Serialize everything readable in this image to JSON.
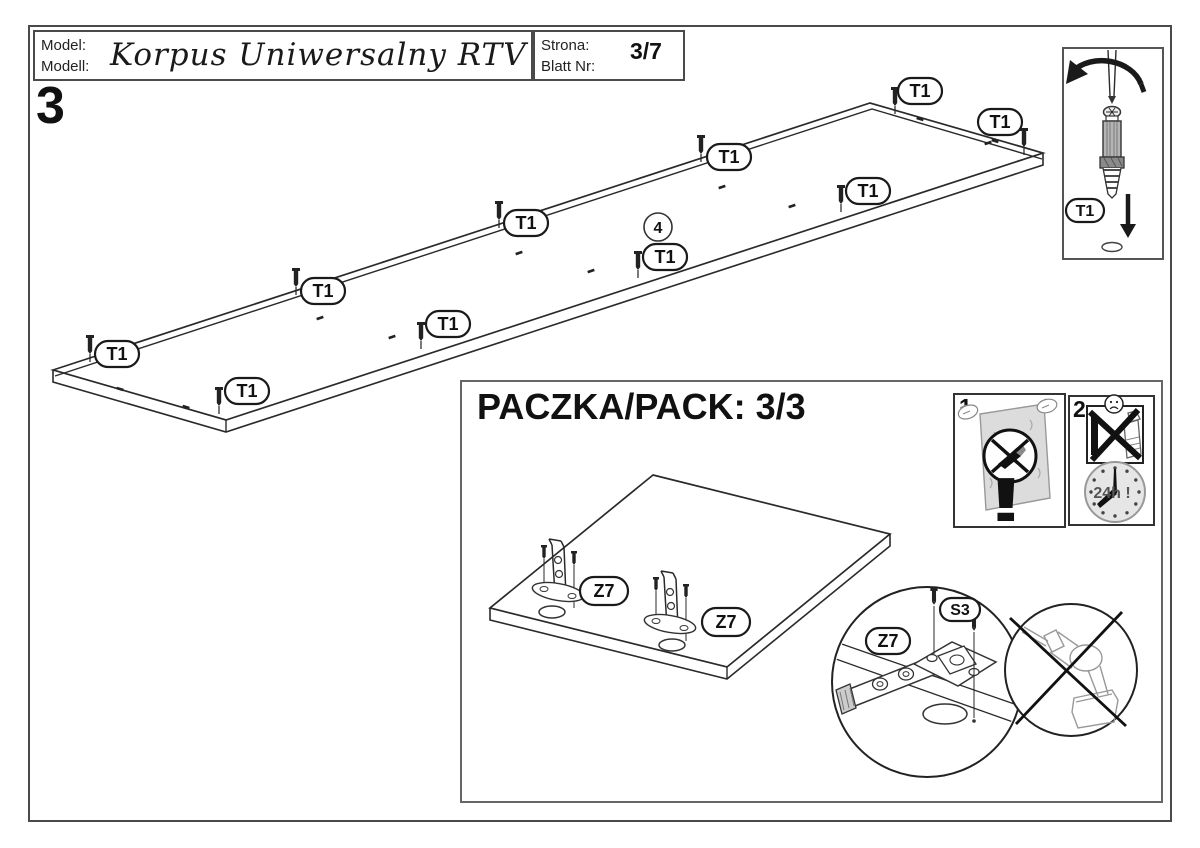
{
  "header": {
    "model_label_1": "Model:",
    "model_label_2": "Modell:",
    "model_name": "Korpus Uniwersalny RTV 200",
    "page_label_1": "Strona:",
    "page_label_2": "Blatt Nr:",
    "page_value": "3/7"
  },
  "step_number": "3",
  "main_diagram": {
    "fastener_label": "T1",
    "part_callout": "4"
  },
  "fastener_detail": {
    "fastener_label": "T1"
  },
  "pack": {
    "title": "PACZKA/PACK: 3/3",
    "hinge_label": "Z7",
    "screw_label": "S3",
    "warning1_number": "1",
    "warning2_number": "2",
    "exclamation_mark": "!",
    "clock_label": "24h !"
  }
}
